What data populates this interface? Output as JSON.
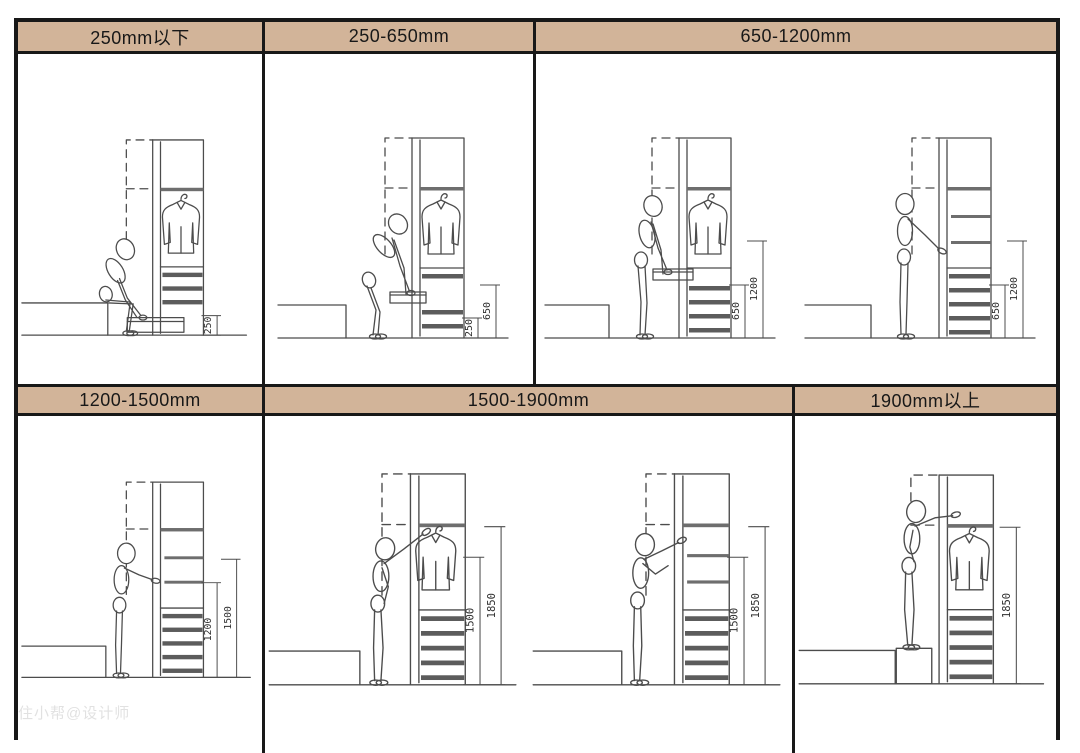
{
  "watermark": "住小帮@设计师",
  "colors": {
    "header_bg": "#d2b499",
    "frame": "#181818",
    "line": "#4c4c4c"
  },
  "headers": {
    "h1": "250mm以下",
    "h2": "250-650mm",
    "h3": "650-1200mm",
    "h4": "1200-1500mm",
    "h5": "1500-1900mm",
    "h6": "1900mm以上"
  },
  "scenes": {
    "s1": {
      "pose": "sitting-reach-low-drawer",
      "dims": {
        "a": "250"
      }
    },
    "s2": {
      "pose": "bending-reach-drawer",
      "dims": {
        "a": "250",
        "b": "650"
      }
    },
    "s3": {
      "pose": "lean-reach-drawer",
      "dims": {
        "a": "650",
        "b": "1200"
      }
    },
    "s4": {
      "pose": "standing-arm-horizontal",
      "dims": {
        "a": "650",
        "b": "1200"
      }
    },
    "s5": {
      "pose": "standing-arm-horizontal",
      "dims": {
        "a": "1200",
        "b": "1500"
      }
    },
    "s6": {
      "pose": "standing-reach-hanger",
      "dims": {
        "a": "1500",
        "b": "1850"
      }
    },
    "s7": {
      "pose": "standing-arm-raised",
      "dims": {
        "a": "1500",
        "b": "1850"
      }
    },
    "s8": {
      "pose": "standing-on-stool-reach-up",
      "dims": {
        "a": "1850"
      }
    }
  }
}
